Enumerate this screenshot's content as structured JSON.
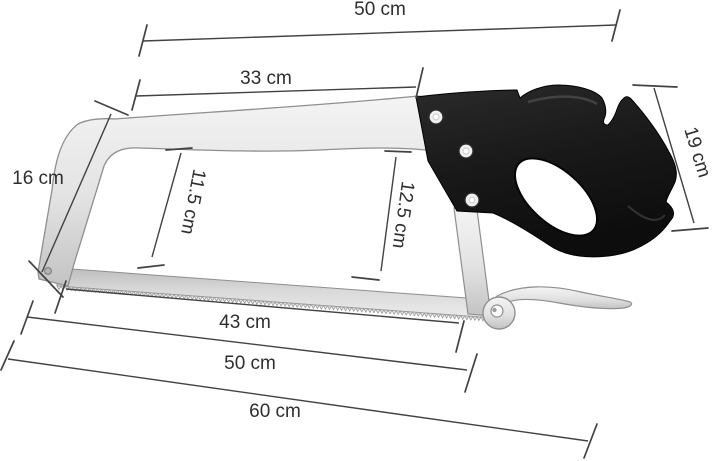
{
  "illustration": {
    "subject": "Butcher meat saw with steel bow frame, serrated blade, scroll tension lever and black pistol-grip handle, annotated with dimension lines"
  },
  "dimensions": {
    "top_overall": "50 cm",
    "top_inner": "33 cm",
    "left_height": "16 cm",
    "inner_left_height": "11.5 cm",
    "inner_right_height": "12.5 cm",
    "handle_side": "19 cm",
    "bottom_inner": "43 cm",
    "bottom_blade": "50 cm",
    "bottom_overall": "60 cm"
  },
  "colors": {
    "background": "#ffffff",
    "dimension_lines": "#424242",
    "label_text": "#2e2e2e",
    "handle": "#191919",
    "frame_light": "#f4f4f4",
    "frame_dark": "#c3c3c3",
    "blade_light": "#ececec",
    "blade_dark": "#bdbdbd",
    "outline": "#8f8f8f"
  }
}
